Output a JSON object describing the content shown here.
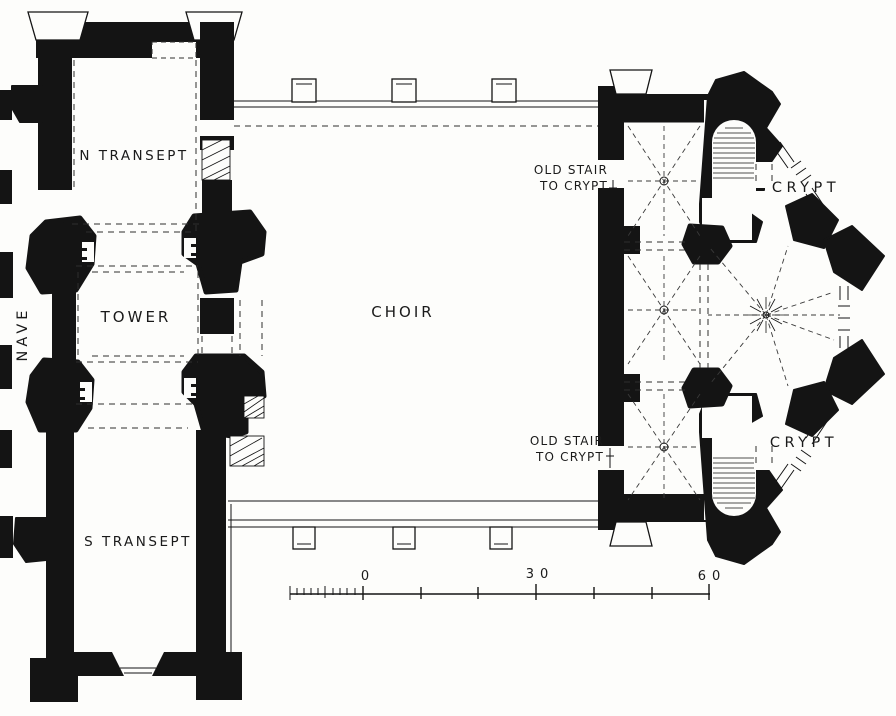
{
  "figure": {
    "type": "church-floor-plan",
    "style": "black ink plan on white paper",
    "paper_color": "#fdfdfb",
    "ink_color": "#141414"
  },
  "labels": {
    "nave": "NAVE",
    "north_transept": "N TRANSEPT",
    "tower": "TOWER",
    "south_transept": "S TRANSEPT",
    "choir": "CHOIR",
    "crypt": "CRYPT",
    "old_stair_line1": "OLD STAIR",
    "old_stair_line2": "TO CRYPT"
  },
  "scale_bar": {
    "tick_labels": [
      "0",
      "30",
      "60"
    ]
  }
}
